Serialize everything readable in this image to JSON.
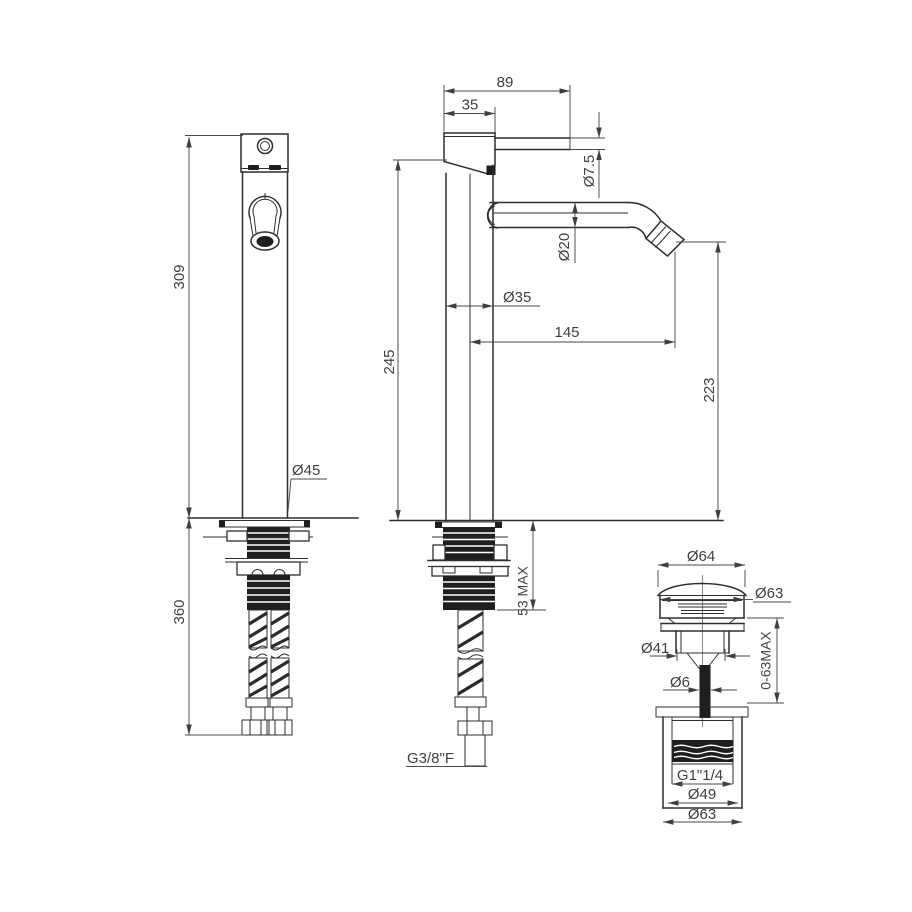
{
  "meta": {
    "type": "technical-drawing",
    "subject": "tall basin mixer tap with pop-up waste",
    "background_color": "#ffffff",
    "line_color": "#2e2e2e"
  },
  "labels": {
    "d89": "89",
    "d35": "35",
    "d75": "Ø7.5",
    "d20": "Ø20",
    "d35b": "Ø35",
    "d145": "145",
    "d245": "245",
    "d223": "223",
    "d309": "309",
    "d360": "360",
    "d45": "Ø45",
    "d53": "53 MAX",
    "g38": "G3/8\"F",
    "d64": "Ø64",
    "d63t": "Ø63",
    "d41": "Ø41",
    "r063": "0-63MAX",
    "d6": "Ø6",
    "g114": "G1\"1/4",
    "d49": "Ø49",
    "d63b": "Ø63"
  }
}
